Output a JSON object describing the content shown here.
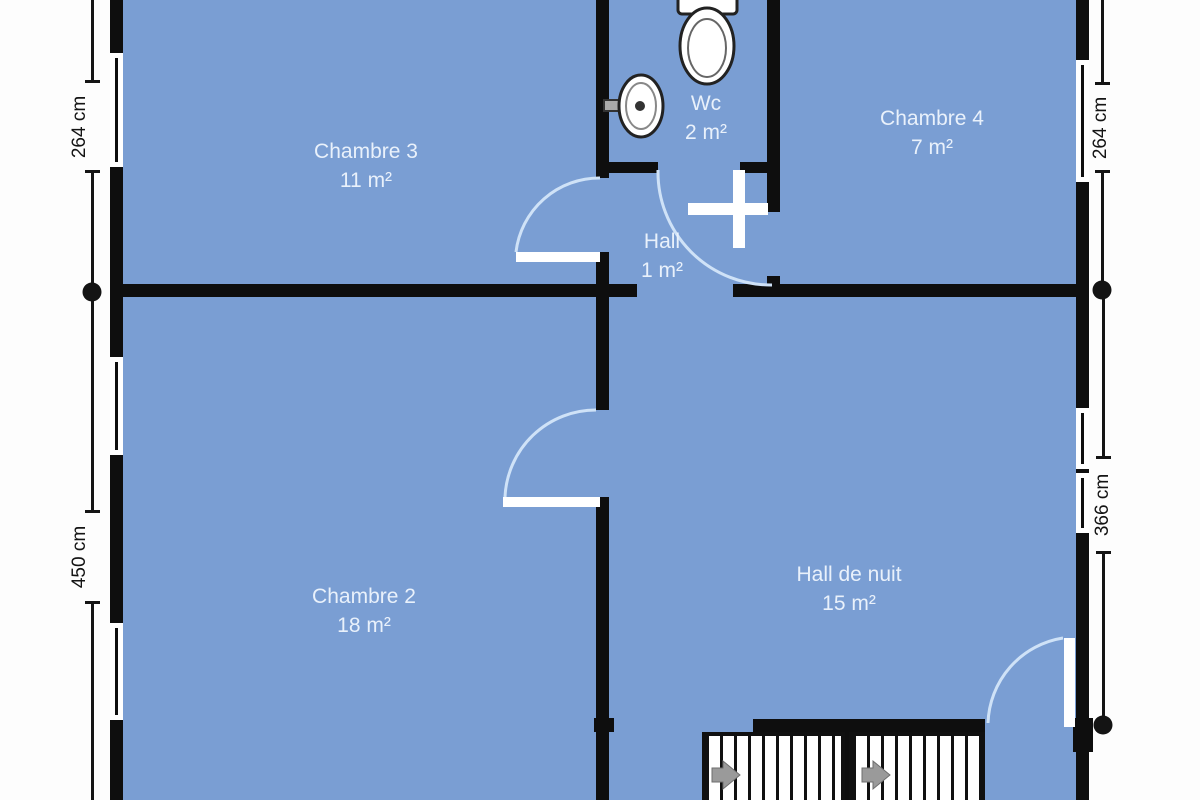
{
  "rooms": [
    {
      "name": "Chambre 3",
      "area": "11 m²"
    },
    {
      "name": "Wc",
      "area": "2 m²"
    },
    {
      "name": "Chambre 4",
      "area": "7 m²"
    },
    {
      "name": "Hall",
      "area": "1 m²"
    },
    {
      "name": "Chambre 2",
      "area": "18 m²"
    },
    {
      "name": "Hall de nuit",
      "area": "15 m²"
    }
  ],
  "dimensions": {
    "left_top": "264 cm",
    "left_bottom": "450 cm",
    "right_top": "264 cm",
    "right_bottom": "366 cm"
  },
  "colors": {
    "floor": "#7a9ed3",
    "wall": "#0e0e0e",
    "door_arc": "#cfe2f7",
    "room_text": "#e9f1fb",
    "dimension_text": "#141414",
    "stair_arrow": "#9a9a9a"
  }
}
